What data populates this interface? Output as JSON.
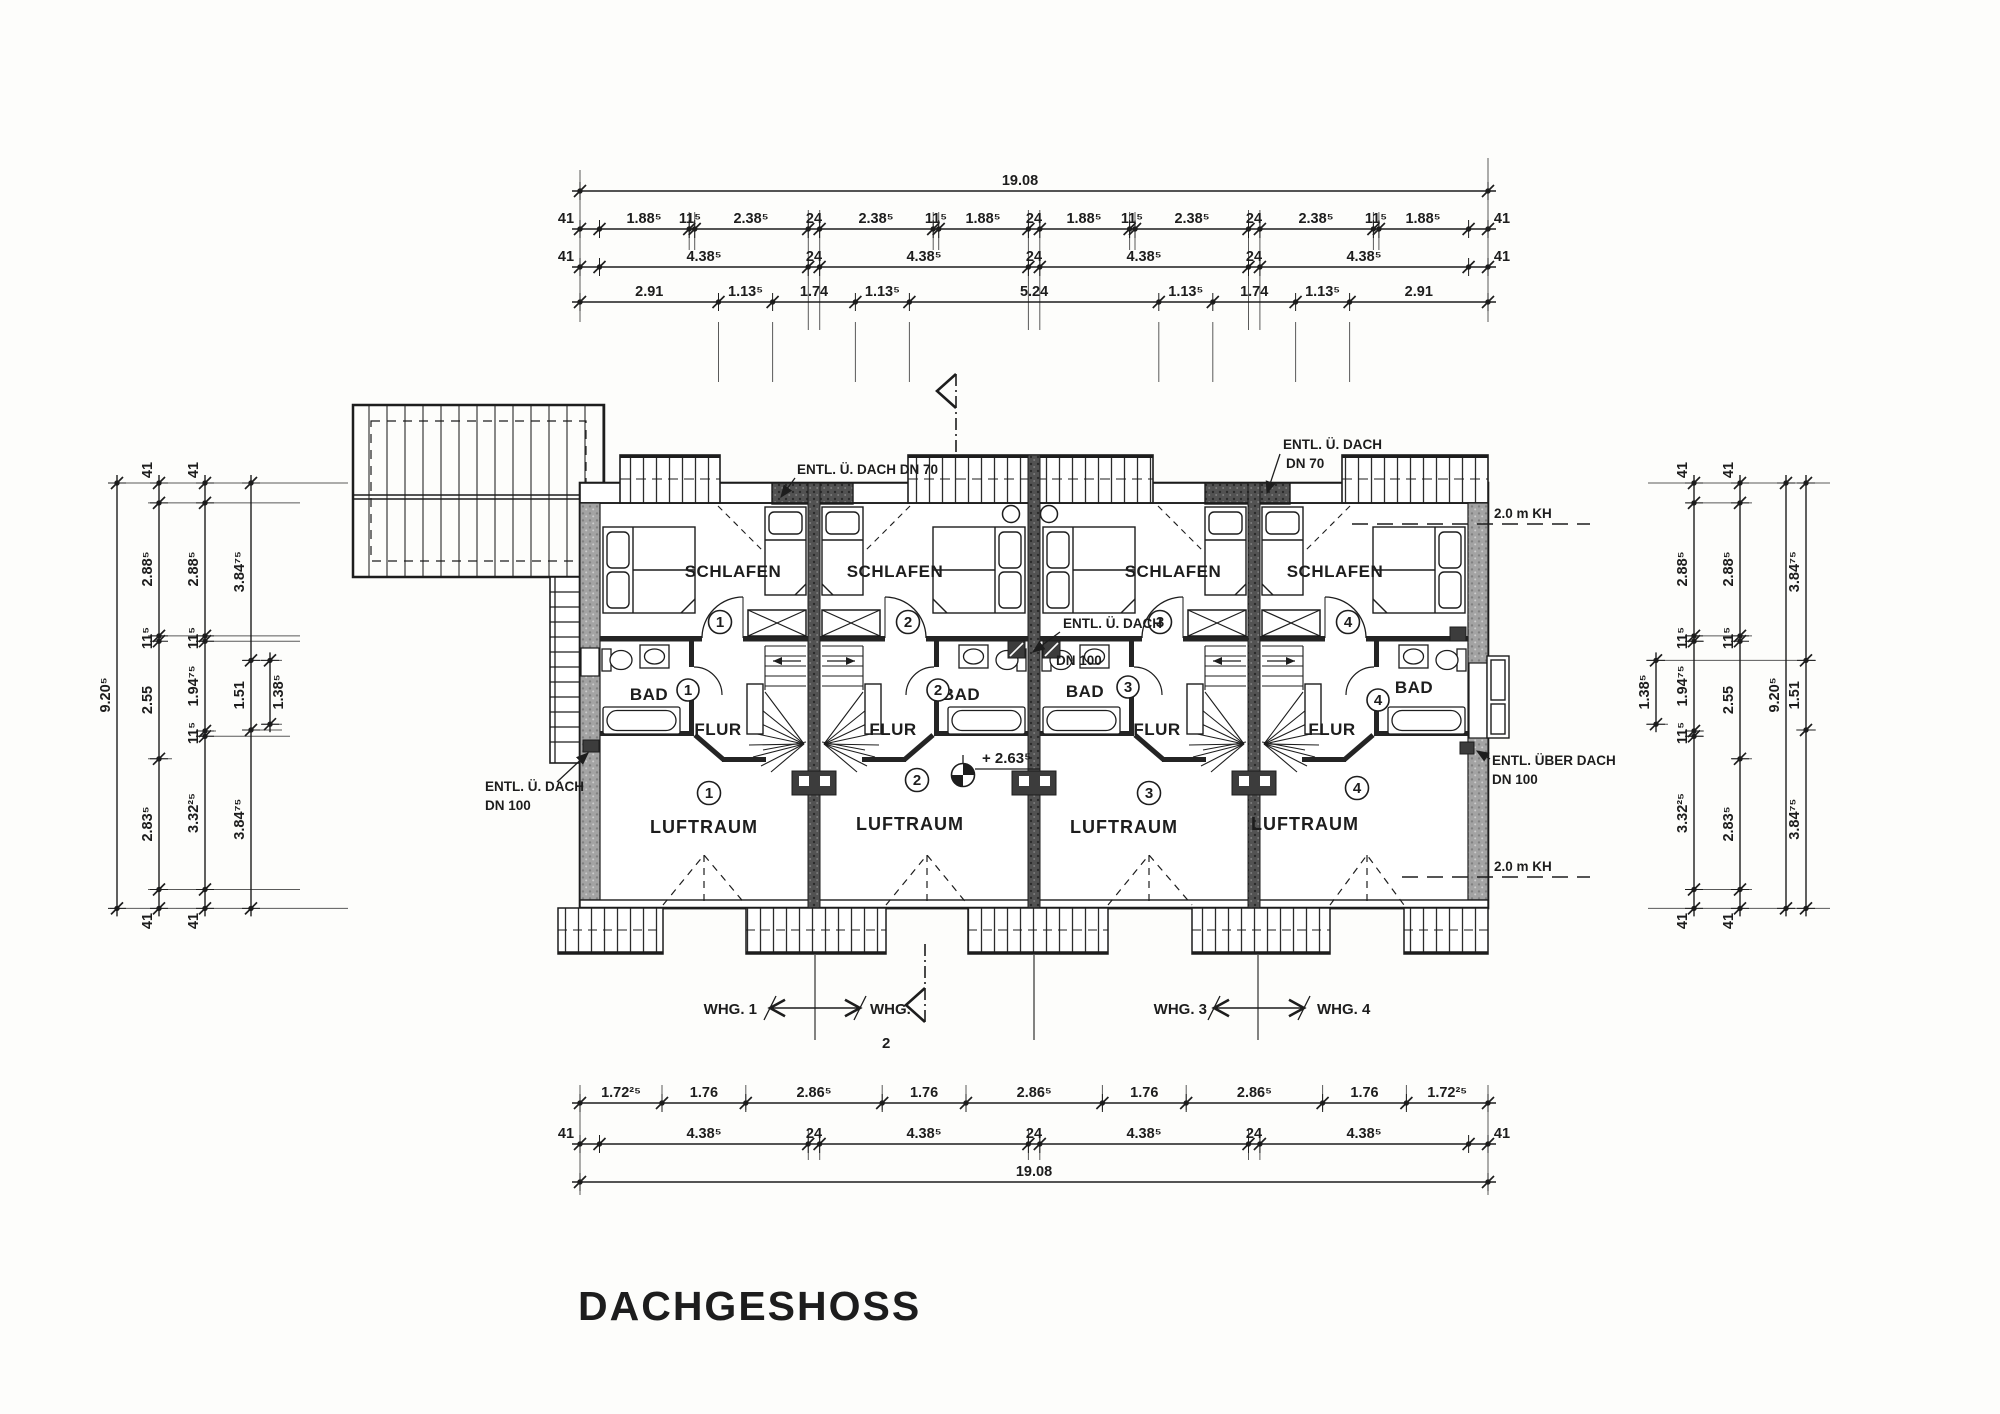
{
  "title": "DACHGESHOSS",
  "rooms": {
    "schlafen": "SCHLAFEN",
    "bad": "BAD",
    "flur": "FLUR",
    "luftraum": "LUFTRAUM"
  },
  "units": [
    "1",
    "2",
    "3",
    "4"
  ],
  "annotations": {
    "entl_inline": "ENTL. Ü. DACH DN 70",
    "entl_dach": "ENTL. Ü. DACH",
    "dn70": "DN 70",
    "dn100": "DN 100",
    "entl_ueber_dach": "ENTL. ÜBER DACH",
    "kh": "2.0 m KH",
    "level": "+ 2.63⁵"
  },
  "apartments": {
    "whg1": "WHG. 1",
    "whg2a": "WHG.",
    "whg2b": "2",
    "whg3": "WHG. 3",
    "whg4": "WHG. 4"
  },
  "dims": {
    "top_total": [
      "19.08"
    ],
    "top_row2": [
      "41",
      "1.88⁵",
      "11⁵",
      "2.38⁵",
      "24",
      "2.38⁵",
      "11⁵",
      "1.88⁵",
      "24",
      "1.88⁵",
      "11⁵",
      "2.38⁵",
      "24",
      "2.38⁵",
      "11⁵",
      "1.88⁵",
      "41"
    ],
    "top_row3": [
      "41",
      "4.38⁵",
      "24",
      "4.38⁵",
      "24",
      "4.38⁵",
      "24",
      "4.38⁵",
      "41"
    ],
    "top_row4": [
      "2.91",
      "1.13⁵",
      "1.74",
      "1.13⁵",
      "5.24",
      "1.13⁵",
      "1.74",
      "1.13⁵",
      "2.91"
    ],
    "bot_row1": [
      "1.72²⁵",
      "1.76",
      "2.86⁵",
      "1.76",
      "2.86⁵",
      "1.76",
      "2.86⁵",
      "1.76",
      "1.72²⁵"
    ],
    "bot_row2": [
      "41",
      "4.38⁵",
      "24",
      "4.38⁵",
      "24",
      "4.38⁵",
      "24",
      "4.38⁵",
      "41"
    ],
    "bot_total": [
      "19.08"
    ],
    "left_total": [
      "9.20⁵"
    ],
    "left_b": [
      "41",
      "2.88⁵",
      "11⁵",
      "2.55",
      "2.83⁵",
      "41"
    ],
    "left_c": [
      "41",
      "2.88⁵",
      "11⁵",
      "1.94⁷⁵",
      "11⁵",
      "3.32²⁵",
      "41"
    ],
    "left_d": [
      "3.84⁷⁵",
      "1.51",
      "3.84⁷⁵"
    ],
    "left_e": [
      "1.38⁵"
    ],
    "right_f": [
      "1.38⁵"
    ],
    "right_c": [
      "41",
      "2.88⁵",
      "11⁵",
      "1.94⁷⁵",
      "11⁵",
      "3.32²⁵",
      "41"
    ],
    "right_b": [
      "41",
      "2.88⁵",
      "11⁵",
      "2.55",
      "2.83⁵",
      "41"
    ],
    "right_total": [
      "9.20⁵"
    ],
    "right_d": [
      "3.84⁷⁵",
      "1.51",
      "3.84⁷⁵"
    ]
  }
}
